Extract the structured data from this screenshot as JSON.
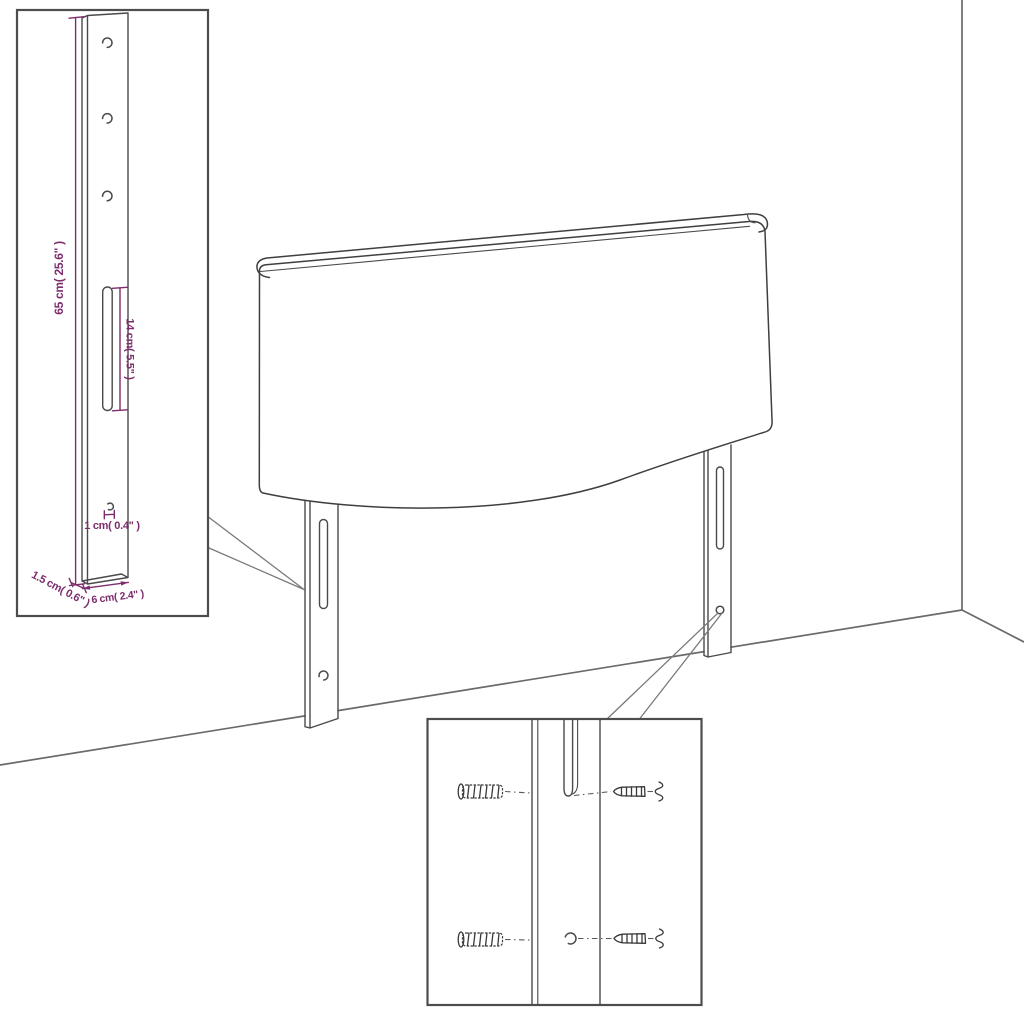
{
  "diagram": {
    "type": "assembly-dimension-diagram",
    "subject": "headboard with mounting legs, wall corner, leg detail inset and wall-fixing hardware inset",
    "labels": {
      "height": "65 cm( 25.6\" )",
      "slot_length": "14 cm( 5.5\" )",
      "hole_size": "1 cm( 0.4\" )",
      "thickness": "1.5 cm( 0.6\" )",
      "leg_width": "6 cm( 2.4\" )"
    },
    "insets": {
      "leg_detail": {
        "holes_count": 3,
        "has_slot": true,
        "has_bottom_hole": true
      },
      "hardware_detail": {
        "rows": 2,
        "parts_per_row": [
          "wall-plug",
          "leg-slot-or-hole",
          "screw"
        ]
      }
    },
    "colors": {
      "dimension_accent": "#7d2c6d",
      "outline": "#3f3f3f",
      "leader_line": "#7a7a7a",
      "wall_line": "#6a6a6a",
      "background": "#ffffff"
    }
  }
}
